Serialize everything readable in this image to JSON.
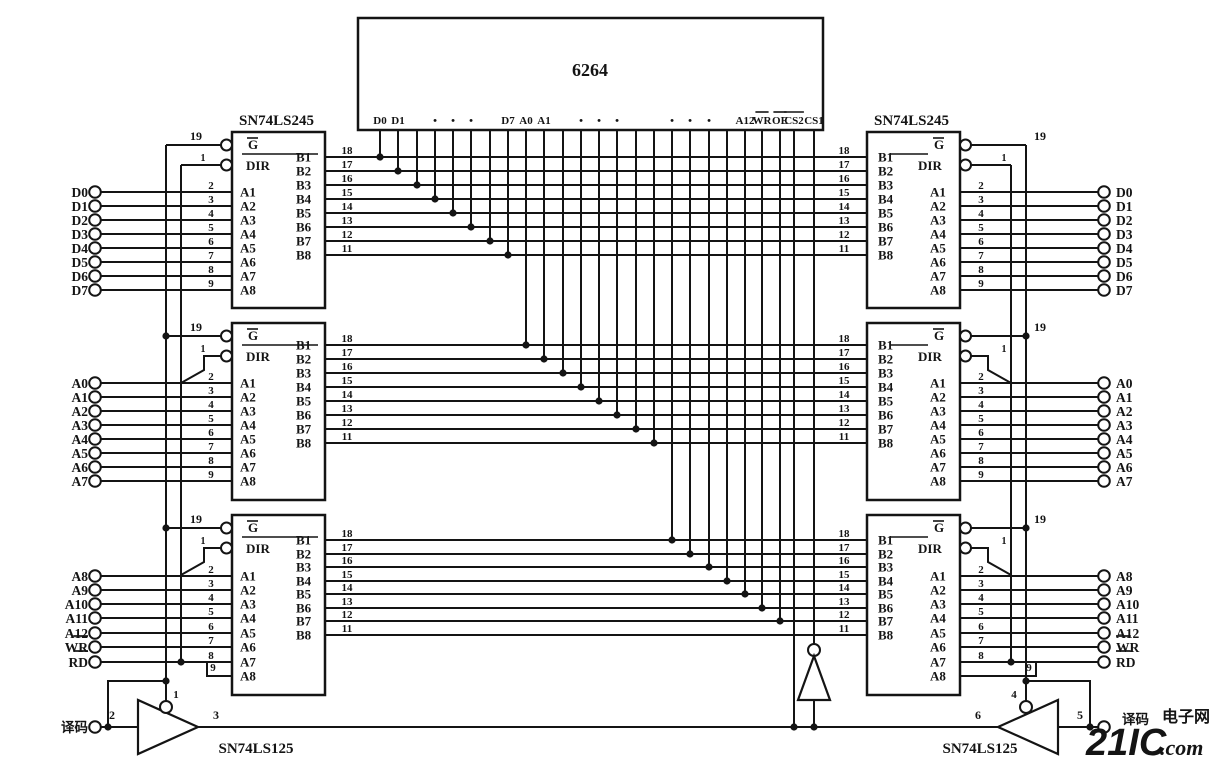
{
  "page": {
    "background": "#ffffff",
    "ink": "#141414"
  },
  "memory": {
    "name": "6264",
    "pin_labels": [
      {
        "t": "D0",
        "p": 0
      },
      {
        "t": "D1",
        "p": 1
      },
      {
        "t": "•",
        "p": 3
      },
      {
        "t": "•",
        "p": 4
      },
      {
        "t": "•",
        "p": 5
      },
      {
        "t": "D7",
        "p": 7
      },
      {
        "t": "A0",
        "p": 8
      },
      {
        "t": "A1",
        "p": 9
      },
      {
        "t": "•",
        "p": 11
      },
      {
        "t": "•",
        "p": 12
      },
      {
        "t": "•",
        "p": 13
      },
      {
        "t": "•",
        "p": 16
      },
      {
        "t": "•",
        "p": 17
      },
      {
        "t": "•",
        "p": 18
      },
      {
        "t": "A12",
        "p": 20
      },
      {
        "t": "WR",
        "p": 21,
        "ov": true
      },
      {
        "t": "OE",
        "p": 22,
        "ov": true
      },
      {
        "t": "CS2",
        "p": 23,
        "ov": true
      },
      {
        "t": "CS1",
        "p": 24
      }
    ]
  },
  "bus_pin_numbers": [
    "18",
    "17",
    "16",
    "15",
    "14",
    "13",
    "12",
    "11"
  ],
  "transceiver": {
    "name": "SN74LS245",
    "a_labels": [
      "A1",
      "A2",
      "A3",
      "A4",
      "A5",
      "A6",
      "A7",
      "A8"
    ],
    "b_labels": [
      "B1",
      "B2",
      "B3",
      "B4",
      "B5",
      "B6",
      "B7",
      "B8"
    ],
    "enable_label": "G",
    "dir_label": "DIR",
    "enable_pin": "19",
    "dir_pin": "1",
    "a_pin_numbers": [
      "2",
      "3",
      "4",
      "5",
      "6",
      "7",
      "8",
      "9"
    ],
    "stub_pin_number": "9"
  },
  "driver": {
    "name": "SN74LS125",
    "left": {
      "input_pin": "2",
      "output_pin": "3",
      "enable_pin": "1"
    },
    "right": {
      "input_pin": "5",
      "output_pin": "6",
      "enable_pin": "4"
    }
  },
  "terminals": {
    "left_data": [
      {
        "t": "D0"
      },
      {
        "t": "D1"
      },
      {
        "t": "D2"
      },
      {
        "t": "D3"
      },
      {
        "t": "D4"
      },
      {
        "t": "D5"
      },
      {
        "t": "D6"
      },
      {
        "t": "D7"
      }
    ],
    "left_address": [
      {
        "t": "A0"
      },
      {
        "t": "A1"
      },
      {
        "t": "A2"
      },
      {
        "t": "A3"
      },
      {
        "t": "A4"
      },
      {
        "t": "A5"
      },
      {
        "t": "A6"
      },
      {
        "t": "A7"
      }
    ],
    "left_high": [
      {
        "t": "A8"
      },
      {
        "t": "A9"
      },
      {
        "t": "A10"
      },
      {
        "t": "A11"
      },
      {
        "t": "A12"
      },
      {
        "t": "WR",
        "ov": true
      },
      {
        "t": "RD",
        "ov": true
      }
    ],
    "left_decode": {
      "t": "译码"
    },
    "right_data": [
      {
        "t": "D0"
      },
      {
        "t": "D1"
      },
      {
        "t": "D2"
      },
      {
        "t": "D3"
      },
      {
        "t": "D4"
      },
      {
        "t": "D5"
      },
      {
        "t": "D6"
      },
      {
        "t": "D7"
      }
    ],
    "right_address": [
      {
        "t": "A0"
      },
      {
        "t": "A1"
      },
      {
        "t": "A2"
      },
      {
        "t": "A3"
      },
      {
        "t": "A4"
      },
      {
        "t": "A5"
      },
      {
        "t": "A6"
      },
      {
        "t": "A7"
      }
    ],
    "right_high": [
      {
        "t": "A8"
      },
      {
        "t": "A9"
      },
      {
        "t": "A10"
      },
      {
        "t": "A11"
      },
      {
        "t": "A12"
      },
      {
        "t": "WR",
        "ov": true
      },
      {
        "t": "RD",
        "ov": true
      }
    ],
    "right_decode": {
      "t": "译码"
    }
  },
  "watermark": {
    "big": "21IC",
    "cjk": "电子网",
    "com": "com",
    "dot": ".",
    "color_big": "#ec9fb2",
    "color_light": "#f3bac7"
  }
}
